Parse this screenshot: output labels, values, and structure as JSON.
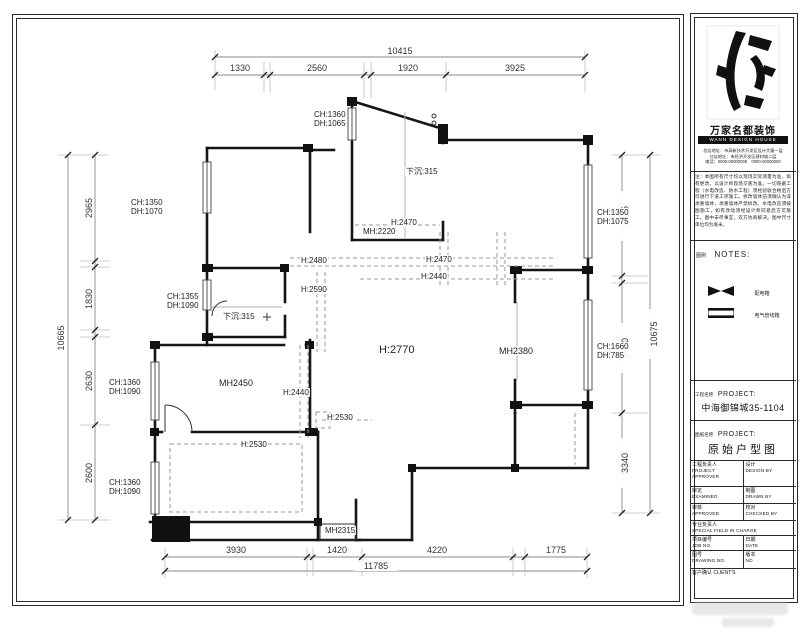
{
  "dims": {
    "top": {
      "total": "10415",
      "segs": [
        "1330",
        "2560",
        "1920",
        "3925"
      ]
    },
    "left": {
      "total": "10665",
      "segs": [
        "2965",
        "1830",
        "2630",
        "2600"
      ]
    },
    "right": {
      "total": "10675",
      "segs": [
        "3425",
        "3710",
        "3340"
      ]
    },
    "bottom": {
      "total": "11785",
      "segs": [
        "3930",
        "1420",
        "4220",
        "1775"
      ]
    }
  },
  "plan": {
    "labels": [
      "CH:1360\nDH:1065",
      "CH:1350\nDH:1070",
      "CH:1350\nDH:1075",
      "CH:1355\nDH:1090",
      "CH:1360\nDH:1090",
      "CH:1360\nDH:1090",
      "CH:1660\nDH:785",
      "下沉:315",
      "下沉:315",
      "H:2470",
      "MH:2220",
      "H:2480",
      "H:2590",
      "H:2470",
      "H:2440",
      "H:2770",
      "MH2380",
      "MH2450",
      "H:2440",
      "H:2530",
      "H:2530",
      "MH2315"
    ]
  },
  "title_block": {
    "company_cn": "万家名都装饰",
    "company_en": "WANN DESIGN HOUSE",
    "address": "总店地址：市高新技术开发区设计大厦一层\n分店地址：市经济开发区建材城二层\n电话：0000-00000000　0000-00000000",
    "note": "注：本图所有尺寸均以现场实际测量为准，如有更改，以设计师现场交底为准。一切隐蔽工程（水电改造、防水工程）须经验收合格后方可进行下道工序施工。拆改墙体前须确认为非承重墙体，承重墙体严禁拆改。水电改造须按图施工，如有改动须经设计师同意后方可施工。图中未尽事宜，双方协商解决。图中尺寸单位均为毫米。",
    "legend_title_cn": "图例",
    "legend_title_en": "NOTES:",
    "legend": [
      {
        "label": "配电箱"
      },
      {
        "label": "电气管线箱"
      }
    ],
    "project_row_cn": "工程名称",
    "project_row_en": "PROJECT:",
    "project_name": "中海御锦城35-1104",
    "drawing_row_cn": "图纸名称",
    "drawing_row_en": "PROJECT:",
    "drawing_name": "原始户型图",
    "cells": {
      "r1l_cn": "工程负责人",
      "r1l_en": "PROJECT APPROVER",
      "r1r_cn": "设计",
      "r1r_en": "DESIGN BY",
      "r2l_cn": "审定",
      "r2l_en": "EXAMINED",
      "r2r_cn": "制图",
      "r2r_en": "DRAWN BY",
      "r3l_cn": "审核",
      "r3l_en": "APPROVED",
      "r3r_cn": "校对",
      "r3r_en": "CHECKED BY",
      "r4_cn": "专业负责人",
      "r4_en": "SPECIAL FIELD IN CHARGE",
      "r5l_cn": "项目编号",
      "r5l_en": "JOB NO.",
      "r5r_cn": "日期",
      "r5r_en": "DATE",
      "r6l_cn": "图号",
      "r6l_en": "DRAWING NO.",
      "r6r_cn": "版本",
      "r6r_en": "NO",
      "r7_cn": "客户确认",
      "r7_en": "CLIENT'S"
    }
  }
}
